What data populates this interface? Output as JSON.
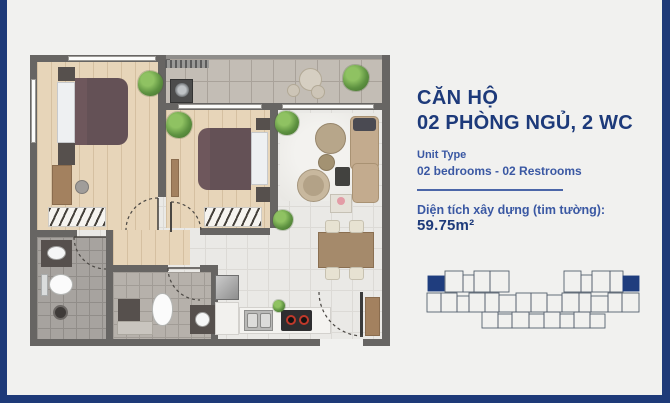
{
  "panel": {
    "title_line1": "CĂN HỘ",
    "title_line2": "02 PHÒNG NGỦ, 2 WC",
    "unit_type_label": "Unit Type",
    "unit_type_value": "02 bedrooms - 02 Restrooms",
    "area_label": "Diện tích xây dựng (tim tường): ",
    "area_value": "59.75m²"
  },
  "colors": {
    "accent_frame": "#1e3a78",
    "title_text": "#1d3a7a",
    "secondary_text": "#3a58a3",
    "wall_gray": "#676563",
    "keyplan_highlight": "#1f3d7e"
  },
  "key_plan": {
    "stroke": "#55606e",
    "highlight": "#1f3d7e",
    "units": [
      {
        "x": 2,
        "y": 8,
        "w": 16,
        "h": 15,
        "f": true
      },
      {
        "x": 19,
        "y": 3,
        "w": 18,
        "h": 21
      },
      {
        "x": 37,
        "y": 7,
        "w": 11,
        "h": 17
      },
      {
        "x": 48,
        "y": 3,
        "w": 16,
        "h": 21
      },
      {
        "x": 64,
        "y": 3,
        "w": 19,
        "h": 21
      },
      {
        "x": 138,
        "y": 3,
        "w": 17,
        "h": 21
      },
      {
        "x": 155,
        "y": 7,
        "w": 11,
        "h": 17
      },
      {
        "x": 166,
        "y": 3,
        "w": 18,
        "h": 21
      },
      {
        "x": 184,
        "y": 3,
        "w": 13,
        "h": 21
      },
      {
        "x": 197,
        "y": 8,
        "w": 16,
        "h": 15,
        "f": true
      },
      {
        "x": 1,
        "y": 25,
        "w": 14,
        "h": 19
      },
      {
        "x": 15,
        "y": 25,
        "w": 16,
        "h": 19
      },
      {
        "x": 31,
        "y": 28,
        "w": 12,
        "h": 16
      },
      {
        "x": 43,
        "y": 25,
        "w": 16,
        "h": 19
      },
      {
        "x": 59,
        "y": 25,
        "w": 14,
        "h": 19
      },
      {
        "x": 73,
        "y": 27,
        "w": 17,
        "h": 17
      },
      {
        "x": 90,
        "y": 25,
        "w": 15,
        "h": 19
      },
      {
        "x": 105,
        "y": 25,
        "w": 16,
        "h": 19
      },
      {
        "x": 121,
        "y": 27,
        "w": 15,
        "h": 17
      },
      {
        "x": 136,
        "y": 25,
        "w": 17,
        "h": 19
      },
      {
        "x": 153,
        "y": 25,
        "w": 12,
        "h": 19
      },
      {
        "x": 165,
        "y": 28,
        "w": 17,
        "h": 16
      },
      {
        "x": 182,
        "y": 25,
        "w": 14,
        "h": 19
      },
      {
        "x": 196,
        "y": 25,
        "w": 17,
        "h": 19
      },
      {
        "x": 56,
        "y": 44,
        "w": 16,
        "h": 16
      },
      {
        "x": 72,
        "y": 46,
        "w": 14,
        "h": 14
      },
      {
        "x": 86,
        "y": 44,
        "w": 17,
        "h": 16
      },
      {
        "x": 103,
        "y": 46,
        "w": 15,
        "h": 14
      },
      {
        "x": 118,
        "y": 44,
        "w": 16,
        "h": 16
      },
      {
        "x": 134,
        "y": 46,
        "w": 14,
        "h": 14
      },
      {
        "x": 148,
        "y": 44,
        "w": 16,
        "h": 16
      },
      {
        "x": 164,
        "y": 46,
        "w": 15,
        "h": 14
      }
    ]
  }
}
